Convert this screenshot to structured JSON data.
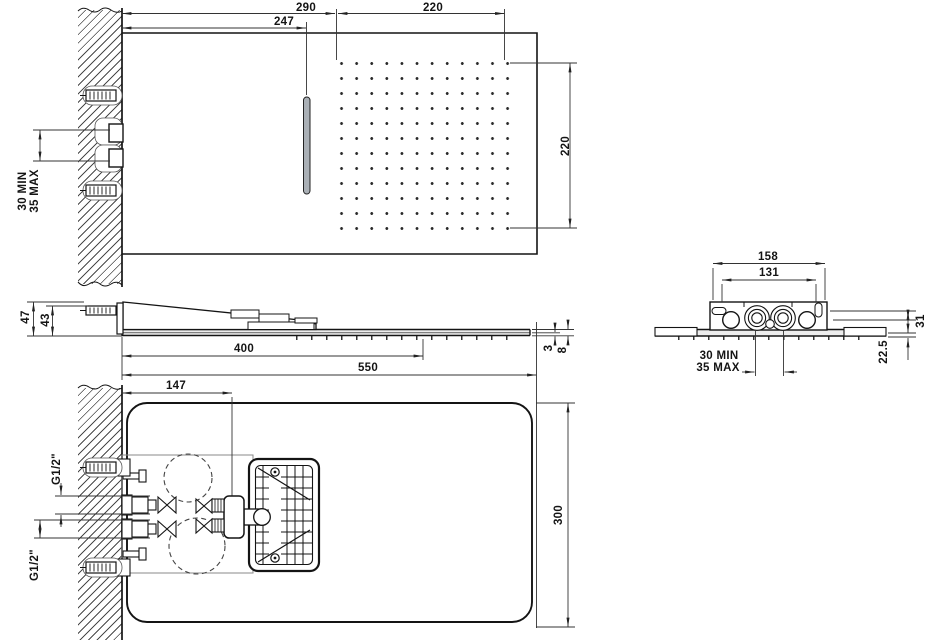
{
  "palette": {
    "line": "#1a1a1a",
    "thin_line": "#333333",
    "background": "#ffffff",
    "slot_fill": "#aab0b6",
    "plate_fill": "#ededed"
  },
  "nozzle_grid": {
    "rows": 12,
    "cols": 12
  },
  "labels": {
    "top_290": "290",
    "top_247": "247",
    "top_220_h": "220",
    "top_220_v": "220",
    "top_offset_min": "30 MIN",
    "top_offset_max": "35 MAX",
    "side_47": "47",
    "side_43": "43",
    "side_400": "400",
    "side_550": "550",
    "side_3": "3",
    "side_8": "8",
    "end_158": "158",
    "end_131": "131",
    "end_31": "31",
    "end_22_5": "22.5",
    "end_offset_min": "30 MIN",
    "end_offset_max": "35 MAX",
    "plan_147": "147",
    "plan_300": "300",
    "plan_g12_top": "G1/2\"",
    "plan_g12_bottom": "G1/2\""
  }
}
